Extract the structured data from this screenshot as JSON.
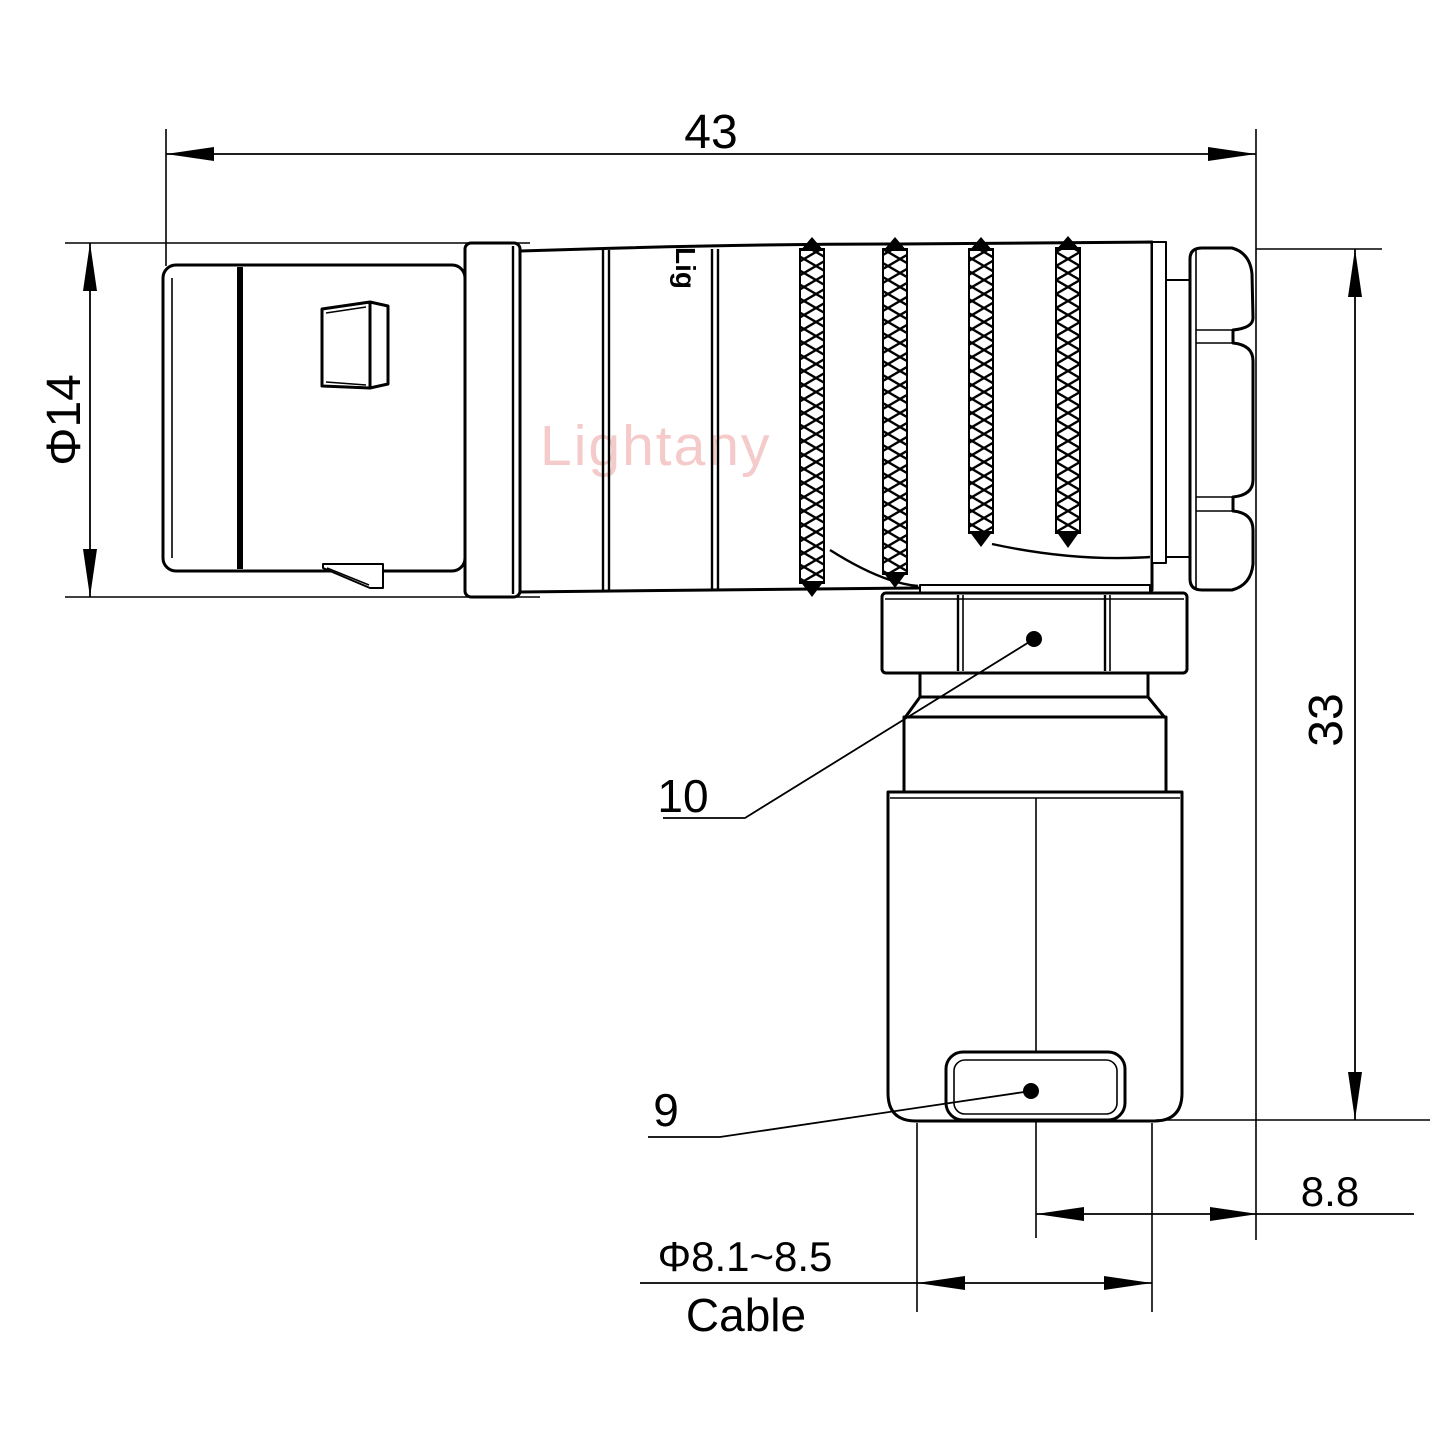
{
  "drawing": {
    "watermark_text": "Lightany",
    "body_brand_text": "Lig",
    "dim_overall_length": "43",
    "dim_front_diameter": "Φ14",
    "dim_height": "33",
    "dim_rear_offset": "8.8",
    "dim_cable_diameter": "Φ8.1~8.5",
    "dim_cable_label": "Cable",
    "label_coupling_nut": "10",
    "label_cable_clamp": "9",
    "colors": {
      "line": "#000000",
      "watermark": "#f5caca",
      "background": "#ffffff"
    }
  }
}
